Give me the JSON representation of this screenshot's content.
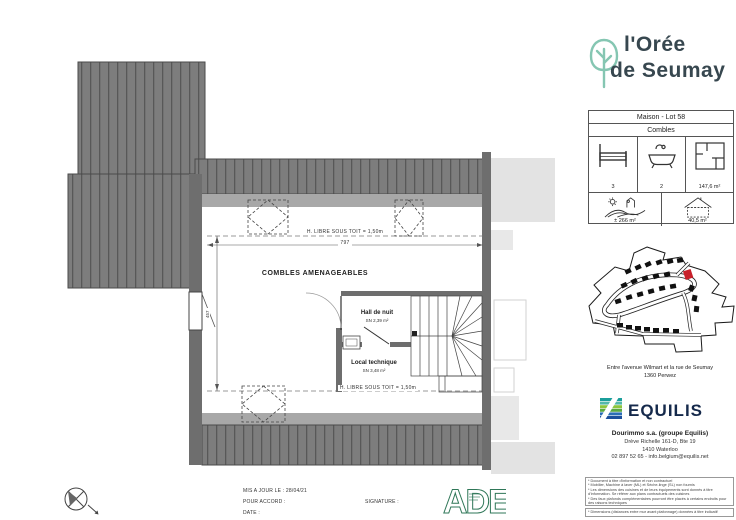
{
  "header": {
    "brand_line1": "l'Orée",
    "brand_line2": "de Seumay"
  },
  "plan": {
    "zone_label": "COMBLES AMENAGEABLES",
    "clearance_top": "H. LIBRE SOUS TOIT = 1,50m",
    "clearance_bottom": "H. LIBRE SOUS TOIT = 1,50m",
    "dim_width": "797",
    "dim_depth": "457",
    "rooms": [
      {
        "name": "Hall de nuit",
        "area": "SN 2,39 m²"
      },
      {
        "name": "Local technique",
        "area": "SN 3,48 m²"
      }
    ]
  },
  "info_box": {
    "title": "Maison - Lot 58",
    "level": "Combles",
    "bedrooms": "3",
    "bathrooms": "2",
    "living_area": "147,6 m²",
    "garden_area": "± 266 m²",
    "footprint_area": "40,5 m²"
  },
  "location": {
    "line1": "Entre l'avenue Wilmart et la rue de Seumay",
    "line2": "1360  Perwez"
  },
  "developer": {
    "brand": "EQUILIS",
    "company": "Dourimmo s.a. (groupe Equilis)",
    "street": "Drève Richelle 161-D, Bte 19",
    "city": "1410  Waterloo",
    "contact": "02 897 52 65 - info.belgium@equilis.net"
  },
  "footer": {
    "updated_label": "MIS A JOUR LE :  28/04/21",
    "approval_label": "POUR ACCORD :",
    "date_label": "DATE :",
    "signature_label": "SIGNATURE :",
    "architect_logo": "ADE"
  },
  "disclaimers": [
    "* Document à titre d'information et non contractuel",
    "* Mobilier, Machine à laver (ML) et Sèche-linge (SL) non fournis",
    "* Les dimensions des cuisines et de leurs équipements sont donnés à titre d'information. Se référer aux plans contractuels des cuisines",
    "* Des faux plafonds complémentaires pourront être placés à certains endroits pour des raisons techniques",
    "* Dimensions (distances entre mur avant plafonnage) données à titre indicatif"
  ],
  "colors": {
    "brand_teal": "#85c6b2",
    "brand_dark": "#37474f",
    "equilis_navy": "#15294b",
    "highlight_red": "#c8202a",
    "roof_gray": "#7d7d7d"
  }
}
